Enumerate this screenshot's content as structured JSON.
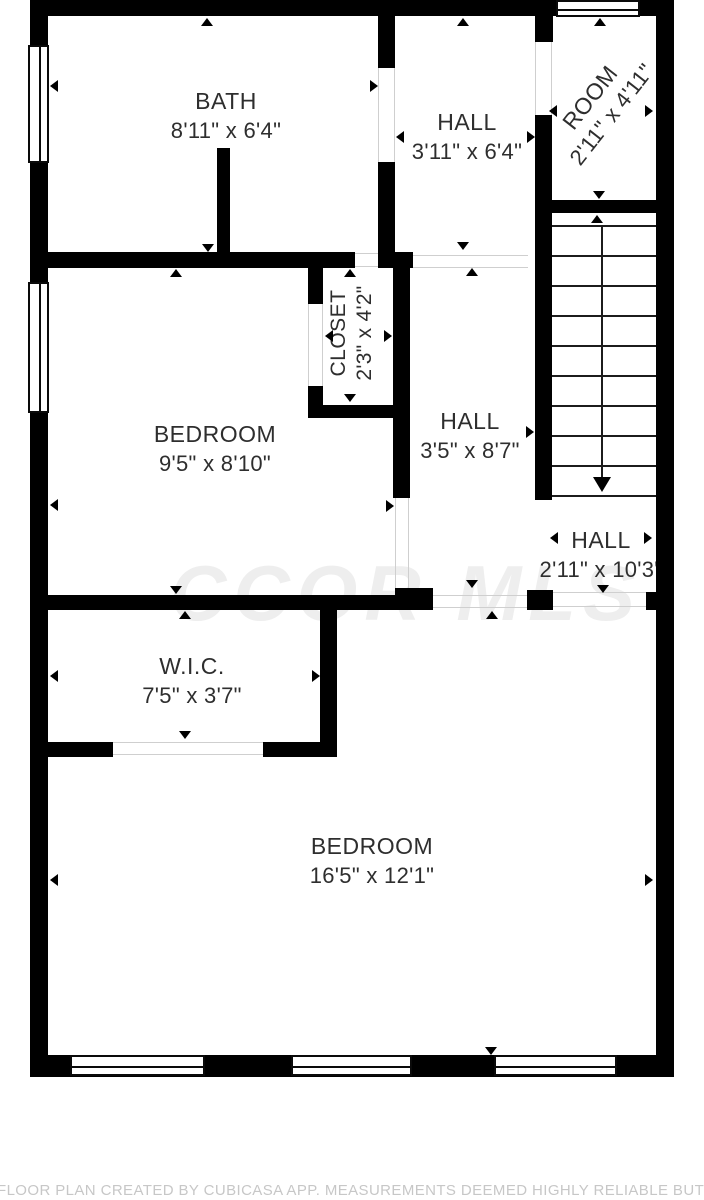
{
  "watermark": "CCOR MLS",
  "footer": "FLOOR PLAN CREATED BY CUBICASA APP. MEASUREMENTS DEEMED HIGHLY RELIABLE BUT NOT GUARANTEED.",
  "rooms": {
    "bath": {
      "name": "BATH",
      "dims": "8'11\" x 6'4\""
    },
    "hall_top": {
      "name": "HALL",
      "dims": "3'11\" x 6'4\""
    },
    "room": {
      "name": "ROOM",
      "dims": "2'11\" x 4'11\""
    },
    "closet": {
      "name": "CLOSET",
      "dims": "2'3\" x 4'2\""
    },
    "bedroom_small": {
      "name": "BEDROOM",
      "dims": "9'5\" x 8'10\""
    },
    "hall_mid": {
      "name": "HALL",
      "dims": "3'5\" x 8'7\""
    },
    "hall_stairs": {
      "name": "HALL",
      "dims": "2'11\" x 10'3\""
    },
    "wic": {
      "name": "W.I.C.",
      "dims": "7'5\" x 3'7\""
    },
    "bedroom_large": {
      "name": "BEDROOM",
      "dims": "16'5\" x 12'1\""
    }
  }
}
